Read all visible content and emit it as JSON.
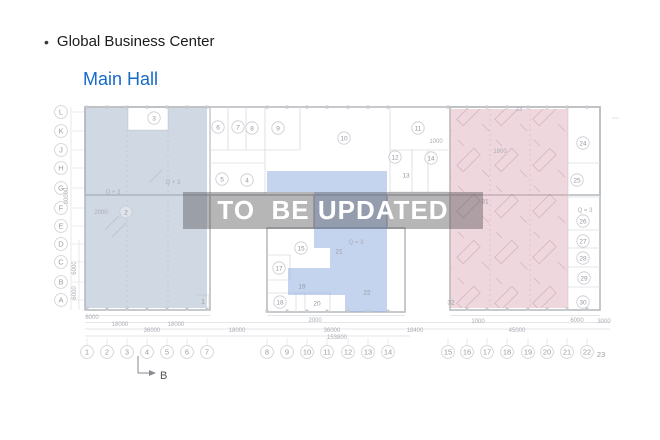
{
  "header": {
    "bullet": "•",
    "title": "Global Business Center",
    "subtitle": "Main Hall"
  },
  "watermark": {
    "text": "TO  BE UPDATED"
  },
  "colors": {
    "title_blue": "#1769c8",
    "watermark_band": "rgba(82,82,84,0.42)",
    "zone_left": "rgba(162,177,199,0.50)",
    "zone_middle": "rgba(148,177,226,0.55)",
    "zone_right": "rgba(219,166,182,0.45)"
  },
  "plan": {
    "row_axis": {
      "x": 61,
      "labels": [
        "L",
        "K",
        "J",
        "H",
        "G",
        "F",
        "E",
        "D",
        "C",
        "B",
        "A"
      ],
      "ys": [
        112,
        131,
        150,
        168,
        188,
        208,
        226,
        244,
        262,
        282,
        300
      ]
    },
    "col_axis": {
      "y": 352,
      "labels": [
        "1",
        "2",
        "3",
        "4",
        "5",
        "6",
        "7",
        "8",
        "9",
        "10",
        "11",
        "12",
        "13",
        "14",
        "15",
        "16",
        "17",
        "18",
        "19",
        "20",
        "21",
        "22"
      ],
      "xs": [
        87,
        107,
        127,
        147,
        167,
        187,
        207,
        267,
        287,
        307,
        327,
        348,
        368,
        388,
        448,
        467,
        487,
        507,
        528,
        547,
        567,
        587
      ],
      "extra": {
        "label": "23",
        "x": 601,
        "y": 357
      }
    },
    "rooms": [
      {
        "n": "3",
        "x": 154,
        "y": 118,
        "c": true
      },
      {
        "n": "2",
        "x": 126,
        "y": 212,
        "c": true
      },
      {
        "n": "1",
        "x": 203,
        "y": 301,
        "c": false
      },
      {
        "n": "6",
        "x": 218,
        "y": 127,
        "c": true
      },
      {
        "n": "7",
        "x": 238,
        "y": 127,
        "c": true
      },
      {
        "n": "8",
        "x": 252,
        "y": 128,
        "c": true
      },
      {
        "n": "9",
        "x": 278,
        "y": 128,
        "c": true
      },
      {
        "n": "10",
        "x": 344,
        "y": 138,
        "c": true
      },
      {
        "n": "5",
        "x": 222,
        "y": 179,
        "c": true
      },
      {
        "n": "4",
        "x": 247,
        "y": 180,
        "c": true
      },
      {
        "n": "11",
        "x": 418,
        "y": 128,
        "c": true
      },
      {
        "n": "12",
        "x": 395,
        "y": 157,
        "c": true
      },
      {
        "n": "14",
        "x": 431,
        "y": 158,
        "c": true
      },
      {
        "n": "13",
        "x": 406,
        "y": 175,
        "c": false
      },
      {
        "n": "15",
        "x": 301,
        "y": 248,
        "c": true
      },
      {
        "n": "17",
        "x": 279,
        "y": 268,
        "c": true
      },
      {
        "n": "19",
        "x": 302,
        "y": 286,
        "c": false
      },
      {
        "n": "18",
        "x": 280,
        "y": 302,
        "c": true
      },
      {
        "n": "20",
        "x": 317,
        "y": 303,
        "c": false
      },
      {
        "n": "21",
        "x": 339,
        "y": 251,
        "c": false
      },
      {
        "n": "22",
        "x": 367,
        "y": 292,
        "c": false
      },
      {
        "n": "31",
        "x": 485,
        "y": 201,
        "c": false
      },
      {
        "n": "32",
        "x": 451,
        "y": 302,
        "c": false
      },
      {
        "n": "24",
        "x": 583,
        "y": 143,
        "c": true
      },
      {
        "n": "25",
        "x": 577,
        "y": 180,
        "c": true
      },
      {
        "n": "26",
        "x": 583,
        "y": 221,
        "c": true
      },
      {
        "n": "27",
        "x": 583,
        "y": 241,
        "c": true
      },
      {
        "n": "28",
        "x": 583,
        "y": 258,
        "c": true
      },
      {
        "n": "29",
        "x": 584,
        "y": 278,
        "c": true
      },
      {
        "n": "30",
        "x": 583,
        "y": 302,
        "c": true
      }
    ],
    "dims": [
      {
        "t": "6000",
        "x": 92,
        "y": 319
      },
      {
        "t": "18000",
        "x": 120,
        "y": 326
      },
      {
        "t": "18000",
        "x": 176,
        "y": 326
      },
      {
        "t": "36000",
        "x": 152,
        "y": 332
      },
      {
        "t": "18000",
        "x": 237,
        "y": 332
      },
      {
        "t": "2000",
        "x": 315,
        "y": 322
      },
      {
        "t": "36000",
        "x": 332,
        "y": 332
      },
      {
        "t": "153800",
        "x": 337,
        "y": 339
      },
      {
        "t": "18400",
        "x": 415,
        "y": 332
      },
      {
        "t": "1000",
        "x": 478,
        "y": 323
      },
      {
        "t": "45000",
        "x": 517,
        "y": 332
      },
      {
        "t": "6000",
        "x": 577,
        "y": 322
      },
      {
        "t": "3000",
        "x": 604,
        "y": 323
      },
      {
        "t": "60000",
        "x": 68,
        "y": 196,
        "r": -90
      },
      {
        "t": "6000",
        "x": 76,
        "y": 268,
        "r": -90
      },
      {
        "t": "6000",
        "x": 76,
        "y": 293,
        "r": -90
      },
      {
        "t": "2000",
        "x": 101,
        "y": 214
      },
      {
        "t": "Q + 3",
        "x": 173,
        "y": 184
      },
      {
        "t": "Q + 3",
        "x": 113,
        "y": 194
      },
      {
        "t": "Q = 3",
        "x": 356,
        "y": 244
      },
      {
        "t": "Q = 3",
        "x": 585,
        "y": 212
      },
      {
        "t": "1800",
        "x": 500,
        "y": 153
      },
      {
        "t": "1000",
        "x": 436,
        "y": 143
      },
      {
        "t": "23",
        "x": 519,
        "y": 111
      }
    ],
    "section_marker": {
      "label": "B"
    }
  }
}
